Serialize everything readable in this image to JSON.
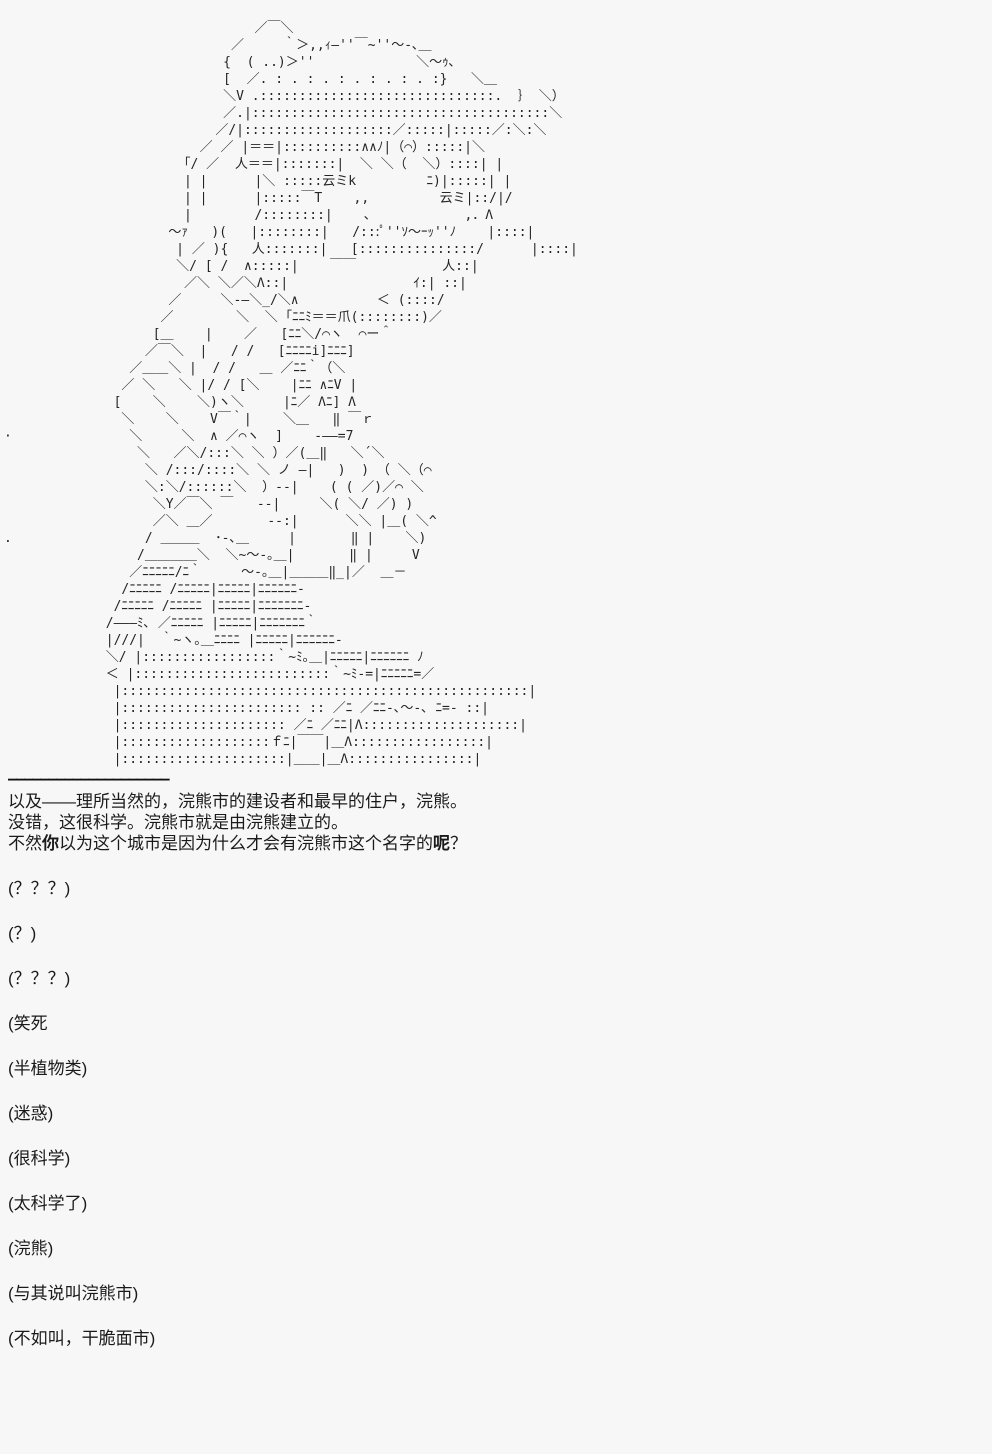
{
  "colors": {
    "background": "#f7f7f7",
    "text": "#1a1a1a",
    "art": "#242424"
  },
  "ascii_art": {
    "lines": [
      "                                ／￣＼",
      "                             ／     ｀＞,,ｨ―''￣~''～-､＿",
      "                            {  ( ..)＞''             ＼～ｩ､",
      "                            [  ／. : . : . : . : . : . :}   ＼＿",
      "                            ＼V .::::::::::::::::::::::::::::::.  ｝ ＼）",
      "                            ／.|::::::::::::::::::::::::::::::::::::::＼",
      "                           ／/|:::::::::::::::::::／:::::|:::::／:＼:＼",
      "                         ／ ／ |＝＝|::::::::::∧∧ﾉ|（⌒）:::::|＼",
      "                       ｢/ ／  人＝＝|:::::::|  ＼ ＼（  ＼）::::| |",
      "                       | |      |＼ :::::云ミk         ﾆ)|:::::| |",
      "                       | |      |:::::￣T    ,,         云ミ|::/|/",
      "                       |        /::::::::|    ､            ,．Λ",
      "                     ～ｧ   )(   |::::::::|   /:::ﾟ''ｿ～ｰｯ''ﾉ    |::::|",
      "                      | ／ ){   人:::::::|   [:::::::::::::::/      |::::|",
      "                      ＼/ [ /  ∧:::::|    ￣￣           人::|",
      "                       ／＼ ＼／＼Λ::|                ｲ:| ::|",
      "                     ／     ＼-―＼_/＼∧          ＜ (::::/",
      "                    ／        ＼  ＼ ｢ﾆﾆﾐ＝＝爪(::::::::)／",
      "                   [＿    |    ／   [ﾆﾆ＼/⌒ヽ  ⌒ー＾",
      "                  ／￣＼  |   / /   [ﾆﾆﾆﾆi]ﾆﾆﾆ]",
      "                ／＿＿＼ |  / /   ＿ ／ﾆﾆ｀（＼",
      "               ／ ＼   ＼ |/ / [＼    |ﾆﾆ ∧ﾆV |",
      "              [    ＼    ＼)ヽ＼     |ﾆ／ Λﾆ] Λ",
      "               ＼    ＼    V￣｀|    ＼＿   ‖ ￣ｒ",
      "·               ＼     ＼  ∧ ／⌒ヽ  ]    -――=7",
      "                 ＼   ／＼/:::＼ ＼ ）／(＿‖   ＼´＼",
      "                  ＼ /:::/::::＼ ＼ ノ ―|   )  ) （ ＼（⌒",
      "                  ＼:＼/::::::＼  ）--|    ( ( ／)／⌒ ＼",
      "                   ＼Y／￣＼ ￣   --|     ＼( ＼/ ／) )",
      "                   ／＼ ＿／       --:|      ＼＼ |＿( ＼^",
      ".                 / ＿＿＿  ･-､＿     |       ‖ |    ＼)",
      "                 /＿＿＿＿＼  ＼~～-｡＿|       ‖ |     V",
      "                ／ﾆﾆﾆﾆﾆ/ﾆ｀     ～-｡＿|＿＿＿‖_|／  ＿－",
      "               /ﾆﾆﾆﾆﾆ /ﾆﾆﾆﾆﾆ|ﾆﾆﾆﾆﾆ|ﾆﾆﾆﾆﾆﾆ-",
      "              /ﾆﾆﾆﾆﾆ /ﾆﾆﾆﾆﾆ |ﾆﾆﾆﾆﾆ|ﾆﾆﾆﾆﾆﾆﾆ-",
      "             /―――ﾐ､ ／ﾆﾆﾆﾆﾆ |ﾆﾆﾆﾆﾆ|ﾆﾆﾆﾆﾆﾆﾆ｀",
      "             |///|  ｀~ヽ｡＿ﾆﾆﾆﾆ |ﾆﾆﾆﾆﾆ|ﾆﾆﾆﾆﾆﾆ-",
      "             ＼/ |:::::::::::::::::｀~ﾐ｡＿|ﾆﾆﾆﾆﾆ|ﾆﾆﾆﾆﾆﾆ ﾉ",
      "             ＜ |:::::::::::::::::::::::::｀~ﾐ-=|ﾆﾆﾆﾆﾆ=／",
      "              |::::::::::::::::::::::::::::::::::::::::::::::::::::|",
      "              |::::::::::::::::::::::: :: ／ﾆ ／ﾆﾆ-､～-､ ﾆ=- ::|",
      "              |::::::::::::::::::::: ／ﾆ ／ﾆﾆ|Λ::::::::::::::::::::|",
      "              |:::::::::::::::::::ｆﾆ|￣￣|＿Λ:::::::::::::::::|",
      "              |:::::::::::::::::::::|＿＿|＿Λ::::::::::::::::|"
    ]
  },
  "separator": "――――――――――――――――――――",
  "narration": {
    "line1": "以及——理所当然的，浣熊市的建设者和最早的住户，浣熊。",
    "line2": "没错，这很科学。浣熊市就是由浣熊建立的。",
    "line3": {
      "pre": "不然",
      "bold1": "你",
      "mid": "以为这个城市是因为什么才会有浣熊市这个名字的",
      "bold2": "呢",
      "post": "？"
    }
  },
  "comments": [
    "(？？？)",
    "(？)",
    "(？？？)",
    "(笑死",
    "(半植物类)",
    "(迷惑)",
    "(很科学)",
    "(太科学了)",
    "(浣熊)",
    "(与其说叫浣熊市)",
    "(不如叫，干脆面市)"
  ]
}
